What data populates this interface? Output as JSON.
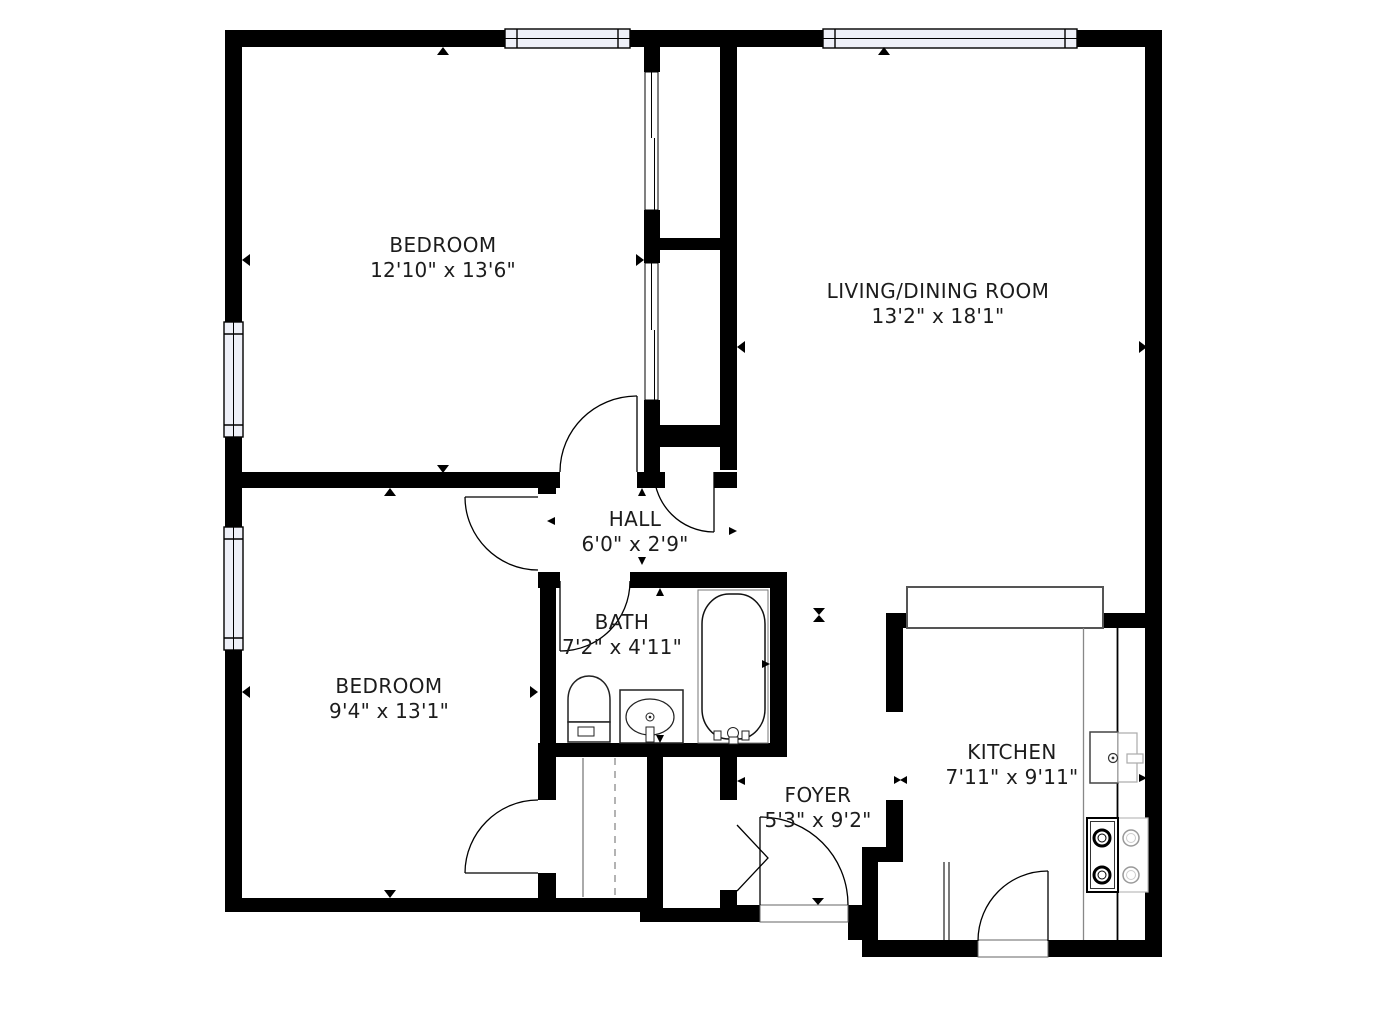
{
  "plan_title": "Apartment floor plan",
  "rooms": [
    {
      "id": "bedroom-1",
      "name": "BEDROOM",
      "dims": "12'10\" x 13'6\""
    },
    {
      "id": "living-dining",
      "name": "LIVING/DINING ROOM",
      "dims": "13'2\" x 18'1\""
    },
    {
      "id": "hall",
      "name": "HALL",
      "dims": "6'0\" x 2'9\""
    },
    {
      "id": "bath",
      "name": "BATH",
      "dims": "7'2\" x 4'11\""
    },
    {
      "id": "bedroom-2",
      "name": "BEDROOM",
      "dims": "9'4\" x 13'1\""
    },
    {
      "id": "foyer",
      "name": "FOYER",
      "dims": "5'3\" x 9'2\""
    },
    {
      "id": "kitchen",
      "name": "KITCHEN",
      "dims": "7'11\" x 9'11\""
    }
  ],
  "colors": {
    "wall": "#000000",
    "window_fill": "#eef0f8",
    "fixture_dark": "#333333",
    "fixture_light": "#999999",
    "counter_stroke": "#555555",
    "background": "#ffffff"
  },
  "fixtures": [
    "bathtub",
    "toilet",
    "sink-vanity",
    "kitchen-sink",
    "stove-burners",
    "counter",
    "closet-rod",
    "bifold-door"
  ]
}
